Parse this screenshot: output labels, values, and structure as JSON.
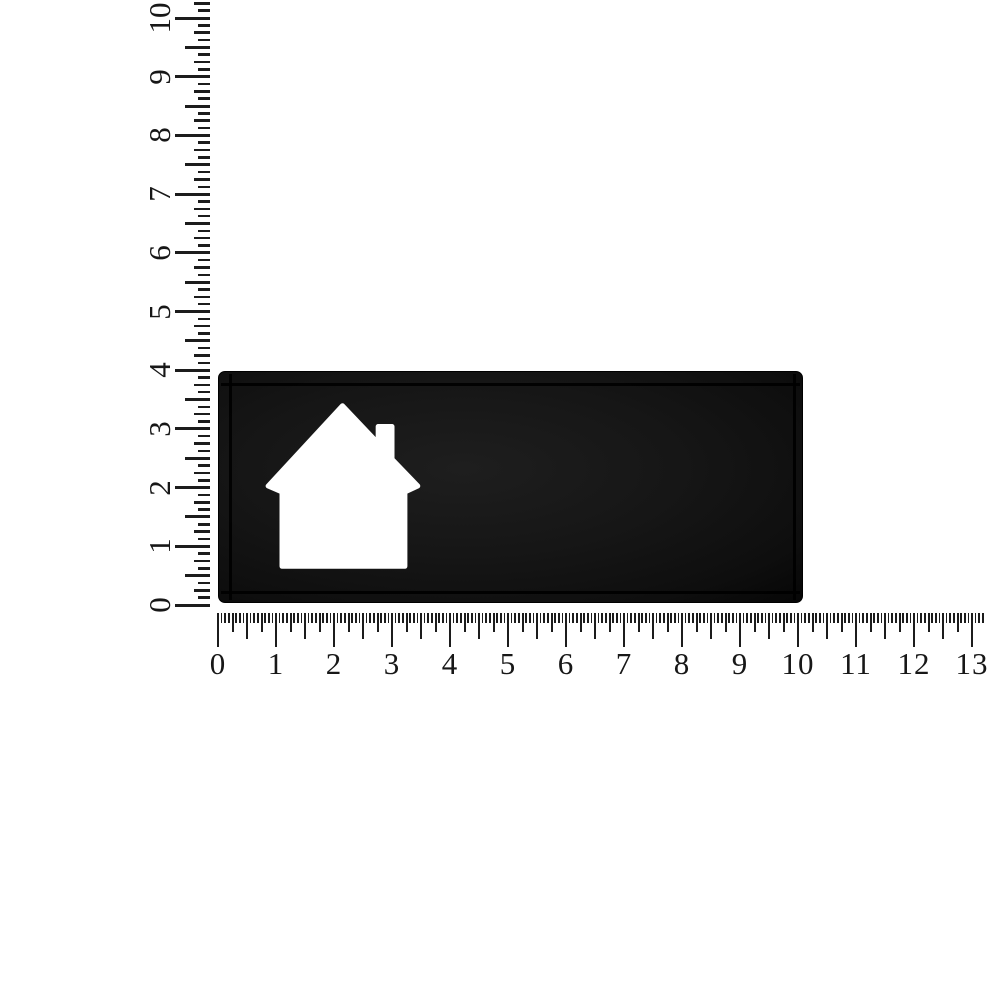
{
  "page": {
    "background_color": "#ffffff"
  },
  "rulers": {
    "color": "#1c1c1c",
    "horizontal": {
      "unit_labels": [
        "0",
        "1",
        "2",
        "3",
        "4",
        "5",
        "6",
        "7",
        "8",
        "9",
        "10",
        "11",
        "12",
        "13"
      ],
      "subdivisions_per_unit": 16,
      "ticks_past_last_label": 3
    },
    "vertical": {
      "unit_labels": [
        "0",
        "1",
        "2",
        "3",
        "4",
        "5",
        "6",
        "7",
        "8",
        "9",
        "10"
      ],
      "subdivisions_per_unit": 8,
      "ticks_past_last_label": 2
    }
  },
  "plaque": {
    "face_color": "#161616",
    "groove_color": "#000000",
    "cutout_color": "#ffffff",
    "house_points": "123,34 159,72 159,55 173,55 173,88 199,115 186,121 186,196 62,196 62,121 48,115"
  }
}
